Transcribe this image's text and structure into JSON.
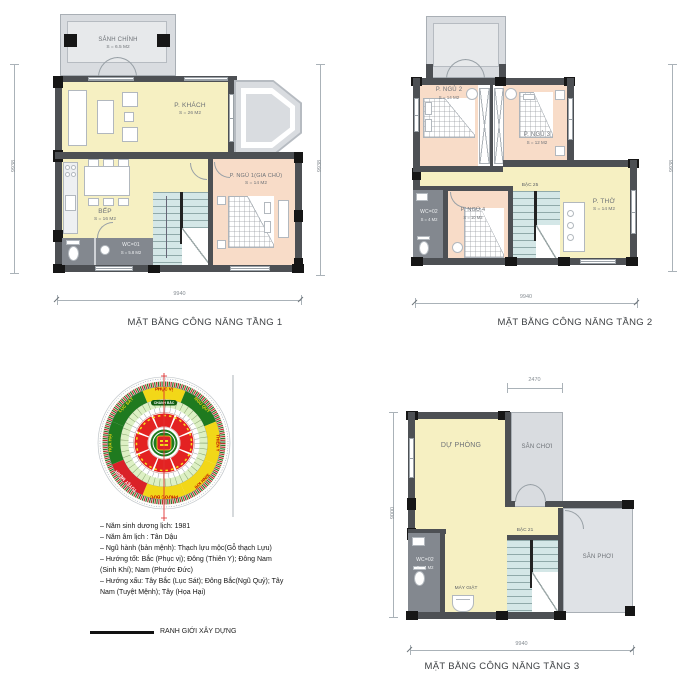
{
  "floor1": {
    "title": "MẶT BẰNG CÔNG NĂNG TẦNG 1",
    "dims": {
      "bottom": "9940",
      "left": "9938",
      "right": "9938"
    },
    "rooms": {
      "sanh_chinh": {
        "name": "SẢNH CHÍNH",
        "area": "S = 6.5 M2"
      },
      "p_khach": {
        "name": "P. KHÁCH",
        "area": "S = 26 M2"
      },
      "bep": {
        "name": "BẾP",
        "area": "S = 16 M2"
      },
      "wc": {
        "name": "WC=01",
        "area": "S = 5.8 M2"
      },
      "p_ngu1": {
        "name": "P. NGỦ 1(GIA CHỦ)",
        "area": "S = 14 M2"
      }
    }
  },
  "floor2": {
    "title": "MẶT BẰNG CÔNG NĂNG TẦNG 2",
    "dims": {
      "bottom": "9940",
      "right": "9938"
    },
    "stair_label": "BẬC 25",
    "rooms": {
      "p_ngu2": {
        "name": "P. NGỦ 2",
        "area": "S = 14 M2"
      },
      "p_ngu3": {
        "name": "P. NGỦ 3",
        "area": "S = 12 M2"
      },
      "p_ngu4": {
        "name": "P. NGỦ 4",
        "area": "S = 10 M2"
      },
      "wc": {
        "name": "WC=02",
        "area": "S = 4 M2"
      },
      "p_tho": {
        "name": "P. THỜ",
        "area": "S = 14 M2"
      }
    }
  },
  "floor3": {
    "title": "MẶT BẰNG CÔNG NĂNG TẦNG 3",
    "dims": {
      "bottom": "9940",
      "top": "2470",
      "left": "9000"
    },
    "stair_label": "BẬC 21",
    "rooms": {
      "du_phong": {
        "name": "DỰ PHÒNG"
      },
      "san_choi": {
        "name": "SÂN CHƠI"
      },
      "san_phoi": {
        "name": "SÂN PHƠI"
      },
      "wc": {
        "name": "WC=02",
        "area": "S = 4 M2"
      },
      "may_giat": {
        "name": "MÁY GIẶT"
      }
    }
  },
  "compass": {
    "directions": {
      "n": "PHỤC VỊ",
      "ne": "NGŨ QUỶ",
      "e": "THIÊN Y",
      "se": "SINH KHÍ",
      "s": "PHƯỚC ĐỨC",
      "sw": "TUYỆT MỆNH",
      "w": "HỌA HẠI",
      "nw": "LỤC SÁT"
    },
    "north_label": "CHÁNH BẮC",
    "colors": {
      "good": "#f2d718",
      "bad_green": "#1f7a1f",
      "bad_red": "#da2128",
      "axis": "#e03030"
    }
  },
  "notes": {
    "lines": [
      "– Năm sinh dương lịch: 1981",
      "– Năm âm lịch : Tân Dậu",
      "– Ngũ hành (bản mệnh): Thạch lựu mộc(Gỗ thạch Lựu)",
      "– Hướng tốt: Bắc (Phục vị); Đông (Thiên Y); Đông Nam (Sinh Khí); Nam (Phước Đức)",
      "– Hướng xấu: Tây Bắc (Lục Sát); Đông Bắc(Ngũ Quỷ); Tây Nam (Tuyệt Mệnh); Tây (Họa Hại)"
    ]
  },
  "legend": {
    "label": "RANH GIỚI XÂY DỰNG"
  }
}
